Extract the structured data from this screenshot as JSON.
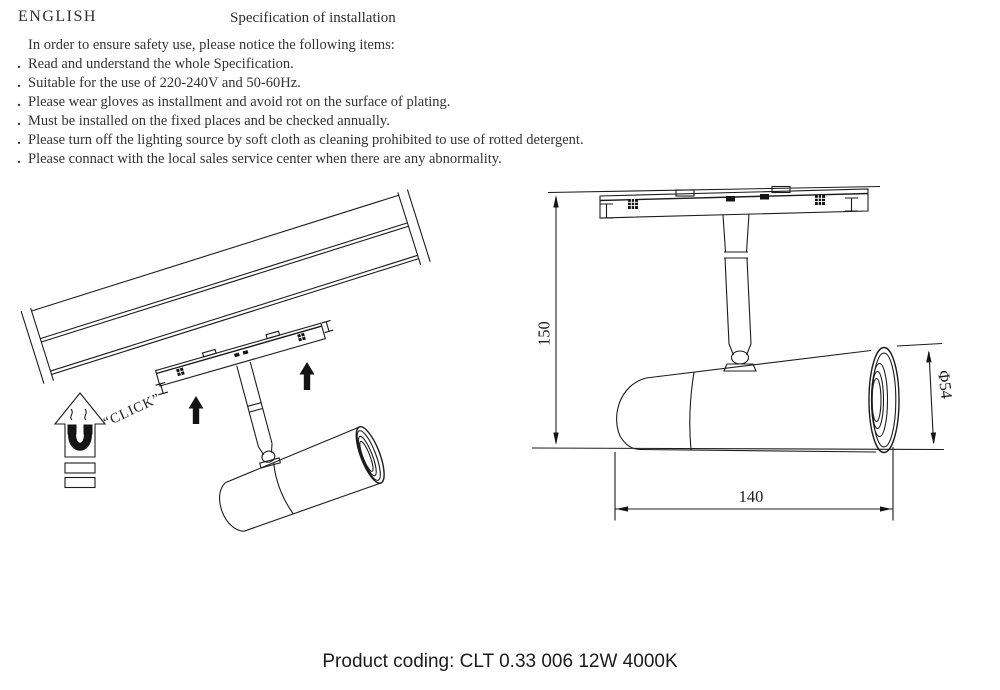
{
  "header": {
    "language": "ENGLISH",
    "title": "Specification of installation"
  },
  "safety": {
    "intro": "In order to ensure safety use, please notice the following items:",
    "bullet": ".",
    "items": [
      "Read and understand the whole Specification.",
      "Suitable for the use of 220-240V and 50-60Hz.",
      "Please wear gloves as installment and avoid rot on the surface of plating.",
      "Must be installed on the fixed places and be checked annually.",
      "Please turn off the lighting source by soft cloth as cleaning prohibited to use of rotted detergent.",
      "Please connact with the local sales service center when there are any abnormality."
    ]
  },
  "left_diagram": {
    "click_label": "“CLICK”"
  },
  "right_diagram": {
    "dim_height": "150",
    "dim_diameter": "Φ54",
    "dim_length": "140"
  },
  "footer": {
    "product_coding": "Product coding: CLT 0.33 006 12W 4000K"
  },
  "colors": {
    "ink": "#1c1c1c",
    "paper": "#ffffff"
  }
}
